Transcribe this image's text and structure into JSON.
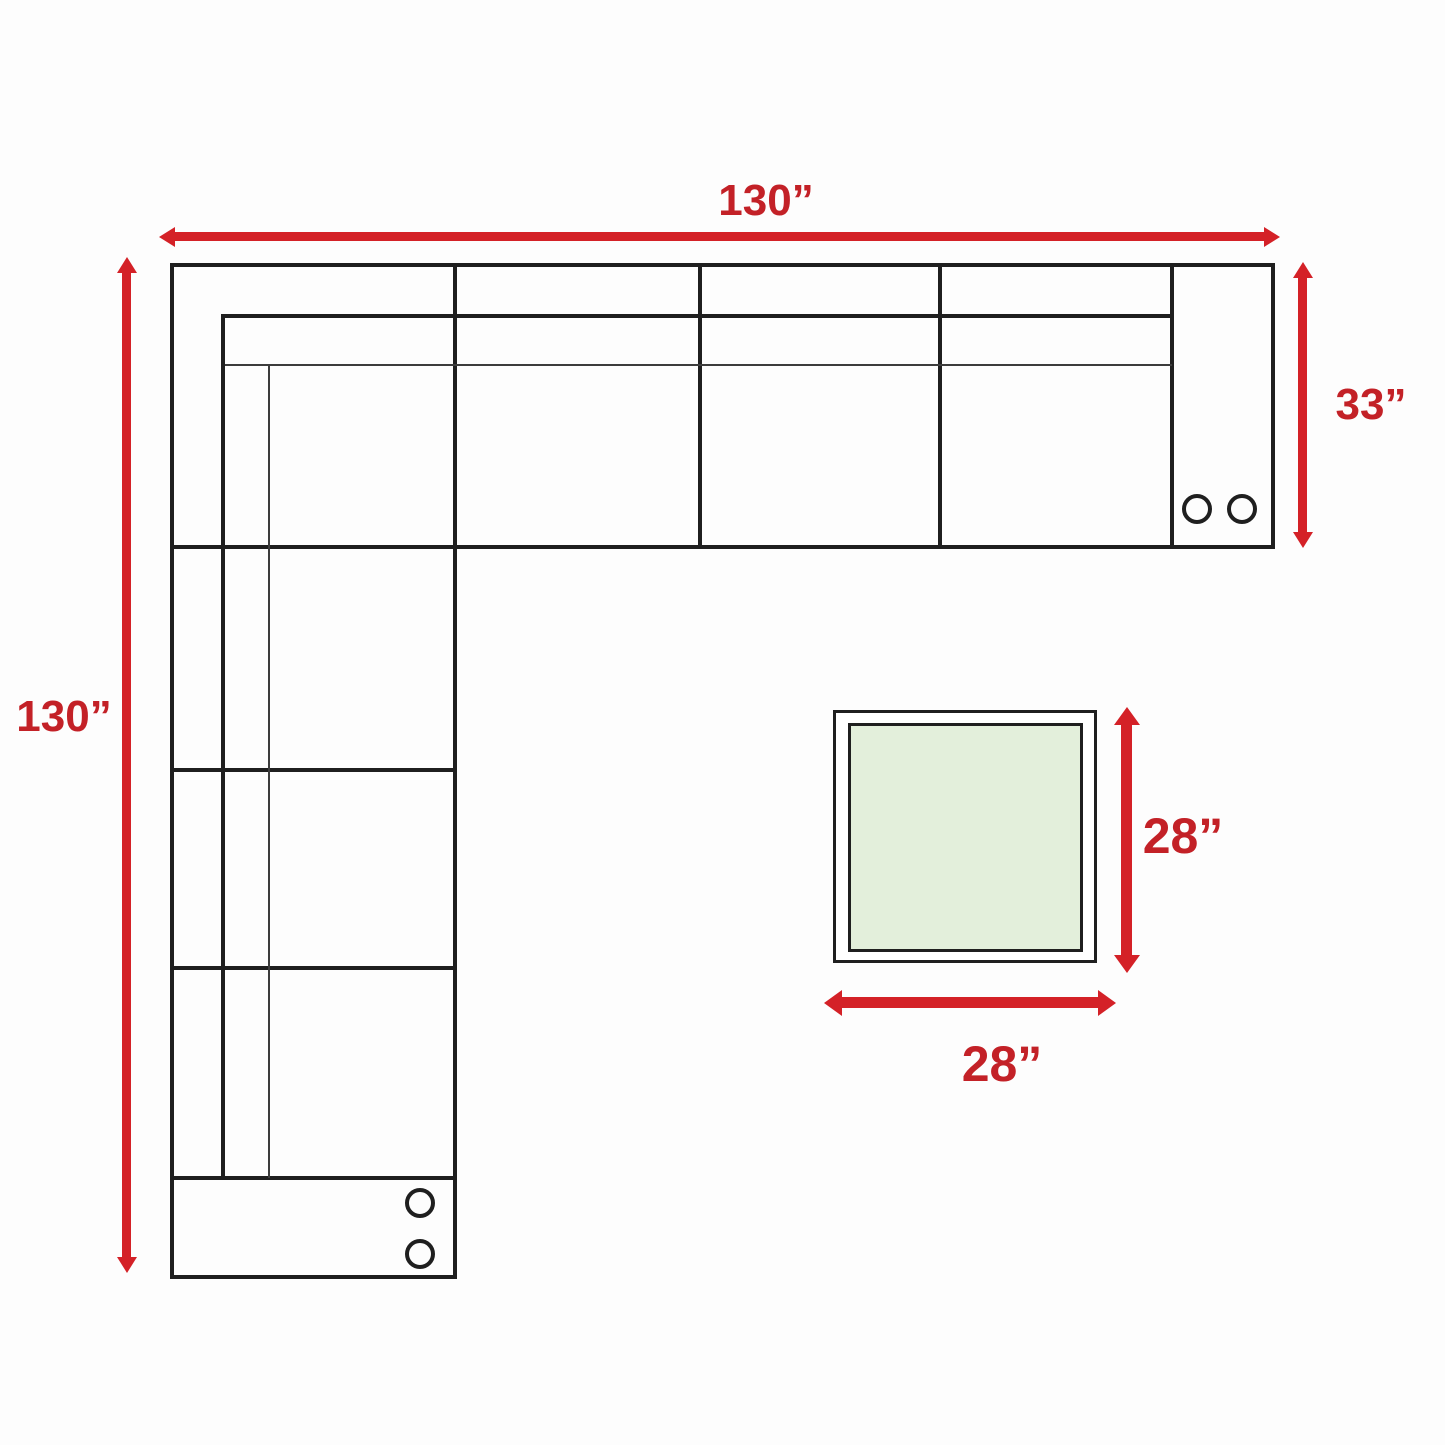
{
  "colors": {
    "background": "#fdfdfd",
    "arrow_red": "#d42127",
    "label_red": "#c32127",
    "line_black": "#1f1f1f",
    "line_thin": "#3c3c3c",
    "table_green": "#e3efdb",
    "surface_white": "#ffffff"
  },
  "dimensions": {
    "sofa_top_width": {
      "label": "130”"
    },
    "sofa_left_length": {
      "label": "130”"
    },
    "sofa_section_depth": {
      "label": "33”"
    },
    "table_depth": {
      "label": "28”"
    },
    "table_width": {
      "label": "28”"
    }
  },
  "sofa": {
    "view": "L-shaped sectional sofa, top view",
    "cupholder_circles": 4
  },
  "table": {
    "view": "square end table, top view"
  }
}
